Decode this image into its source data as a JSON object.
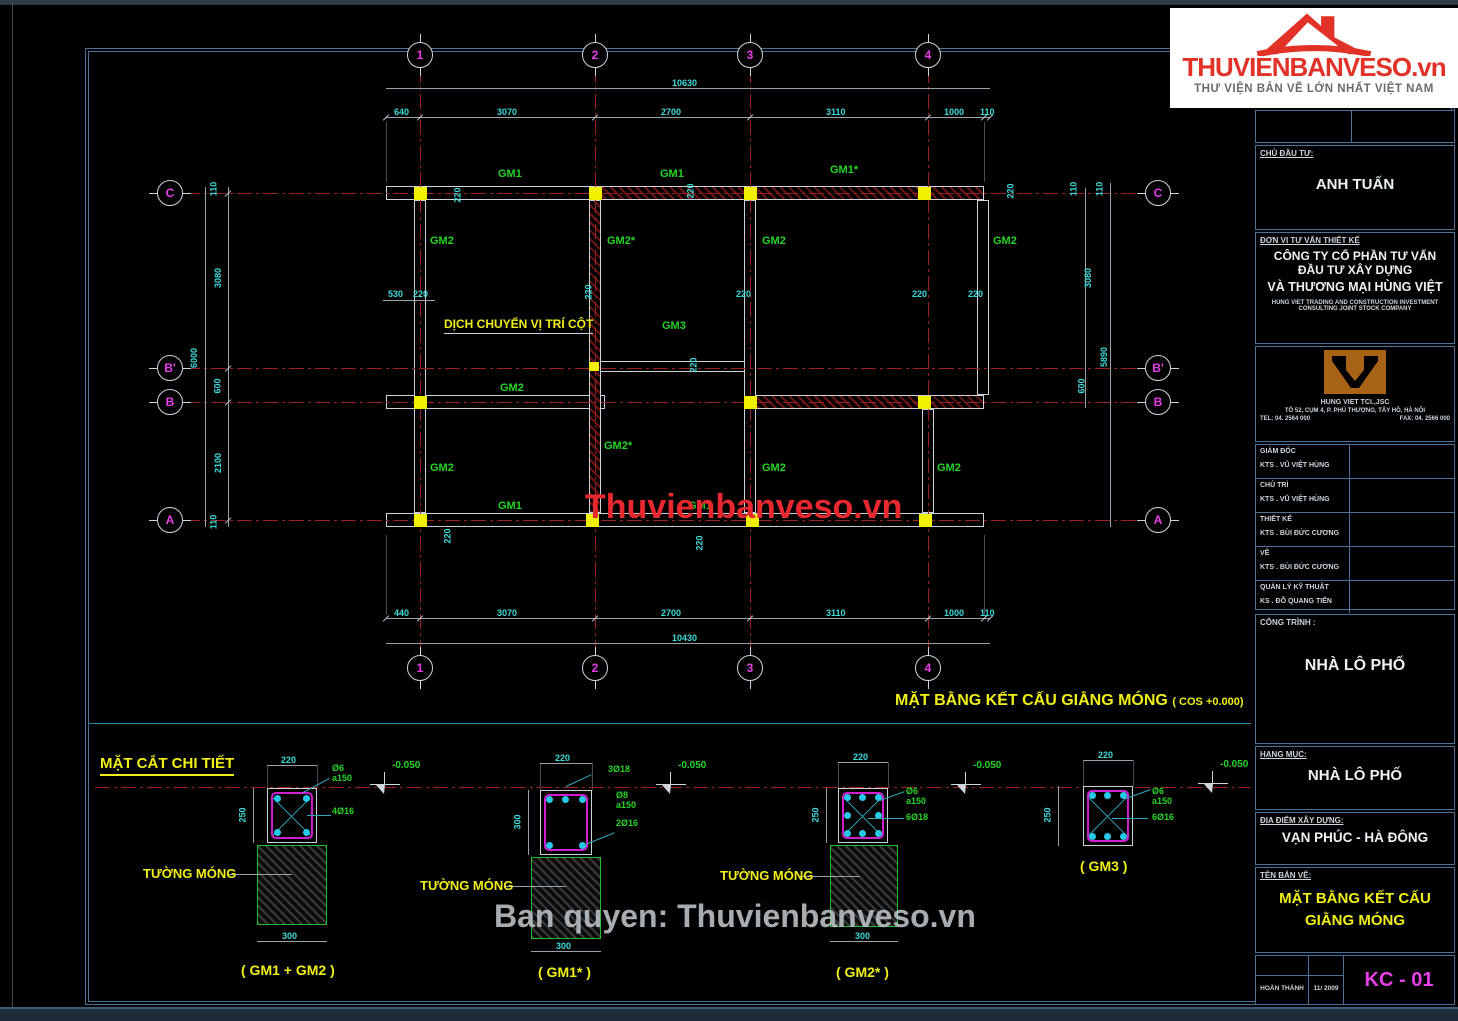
{
  "logo": {
    "brand": "THUVIENBANVESO",
    "suffix": ".vn",
    "tagline": "THƯ VIỆN BẢN VẼ LỚN NHẤT VIỆT NAM"
  },
  "watermarks": {
    "center": "Thuvienbanveso.vn",
    "bottom": "Ban quyen: Thuvienbanveso.vn"
  },
  "plan": {
    "title": "MẶT BẰNG KẾT CẤU GIẰNG MÓNG",
    "cos_note": "( COS +0.000)",
    "note": "DỊCH CHUYỂN VỊ TRÍ CỘT",
    "cols": [
      "1",
      "2",
      "3",
      "4"
    ],
    "rows": [
      "C",
      "B'",
      "B",
      "A"
    ],
    "labels": {
      "gm1": "GM1",
      "gm1s": "GM1*",
      "gm2": "GM2",
      "gm2s": "GM2*",
      "gm3": "GM3"
    },
    "dims": {
      "top_total": "10630",
      "bottom_total": "10430",
      "left_total": "6000",
      "right_total": "5890",
      "top": [
        "640",
        "3070",
        "2700",
        "3110",
        "1000",
        "110"
      ],
      "bottom": [
        "440",
        "3070",
        "2700",
        "3110",
        "1000",
        "110"
      ],
      "left": [
        "110",
        "3080",
        "600",
        "2100",
        "110"
      ],
      "right": [
        "110",
        "110",
        "3080",
        "600"
      ],
      "d220": "220",
      "d530": "530"
    }
  },
  "details": {
    "header": "MẶT CẮT CHI TIẾT",
    "level": "-0.050",
    "wall_label": "TƯỜNG MÓNG",
    "dims": {
      "w": "220",
      "h250": "250",
      "h300": "300",
      "base": "300"
    },
    "items": [
      {
        "caption": "( GM1 + GM2 )",
        "stirrup": "Ø6",
        "spacing": "a150",
        "main": "4Ø16"
      },
      {
        "caption": "( GM1* )",
        "top_bars": "3Ø18",
        "stirrup": "Ø8",
        "spacing": "a150",
        "bottom_bars": "2Ø16"
      },
      {
        "caption": "( GM2* )",
        "stirrup": "Ø6",
        "spacing": "a150",
        "main": "6Ø18"
      },
      {
        "caption": "( GM3 )",
        "stirrup": "Ø6",
        "spacing": "a150",
        "main": "6Ø16"
      }
    ]
  },
  "titleblock": {
    "investor_label": "CHỦ ĐẦU TƯ:",
    "investor": "ANH TUẤN",
    "consultant_label": "ĐƠN VỊ TƯ VẤN THIẾT KẾ",
    "company": [
      "CÔNG TY CỔ PHẦN TƯ VẤN",
      "ĐẦU TƯ XÂY DỰNG",
      "VÀ THƯƠNG MẠI HÙNG VIỆT"
    ],
    "company_en": [
      "HUNG VIET TRADING AND CONSTRUCTION INVESTMENT",
      "CONSULTING JOINT STOCK COMPANY"
    ],
    "firm_short": "HUNG VIET TCI.,JSC",
    "address": "TỔ 52, CỤM 4, P. PHÚ THƯỢNG, TÂY HỒ, HÀ NỘI",
    "tel": "TEL: 04. 2564 000",
    "fax": "FAX: 04. 2566 000",
    "staff": [
      {
        "role": "GIÁM ĐỐC",
        "name": "KTS . VŨ VIỆT HÙNG"
      },
      {
        "role": "CHỦ TRÌ",
        "name": "KTS . VŨ VIỆT HÙNG"
      },
      {
        "role": "THIẾT KẾ",
        "name": "KTS . BÙI ĐỨC CƯƠNG"
      },
      {
        "role": "VẼ",
        "name": "KTS . BÙI ĐỨC CƯƠNG"
      },
      {
        "role": "QUẢN LÝ KỸ THUẬT",
        "name": "KS . ĐỖ QUANG TIẾN"
      }
    ],
    "project_label": "CÔNG TRÌNH :",
    "project": "NHÀ LÔ PHỐ",
    "item_label": "HẠNG MỤC:",
    "item": "NHÀ LÔ PHỐ",
    "location_label": "ĐỊA ĐIỂM XÂY DỰNG:",
    "location": "VẠN PHÚC - HÀ ĐÔNG",
    "drawing_label": "TÊN BẢN VẼ:",
    "drawing_name": [
      "MẶT BẰNG KẾT CẤU",
      "GIẰNG MÓNG"
    ],
    "completed_label": "HOÀN THÀNH",
    "completed_date": "11/ 2009",
    "sheet_code": "KC - 01"
  },
  "colors": {
    "accent_yellow": "#f0ef19",
    "dim_cyan": "#3fd9d9",
    "label_green": "#25d425",
    "grid_magenta": "#e83ee8",
    "axis_red": "#9c2020",
    "frame_blue": "#4c7096",
    "brand_red": "#e23227"
  }
}
